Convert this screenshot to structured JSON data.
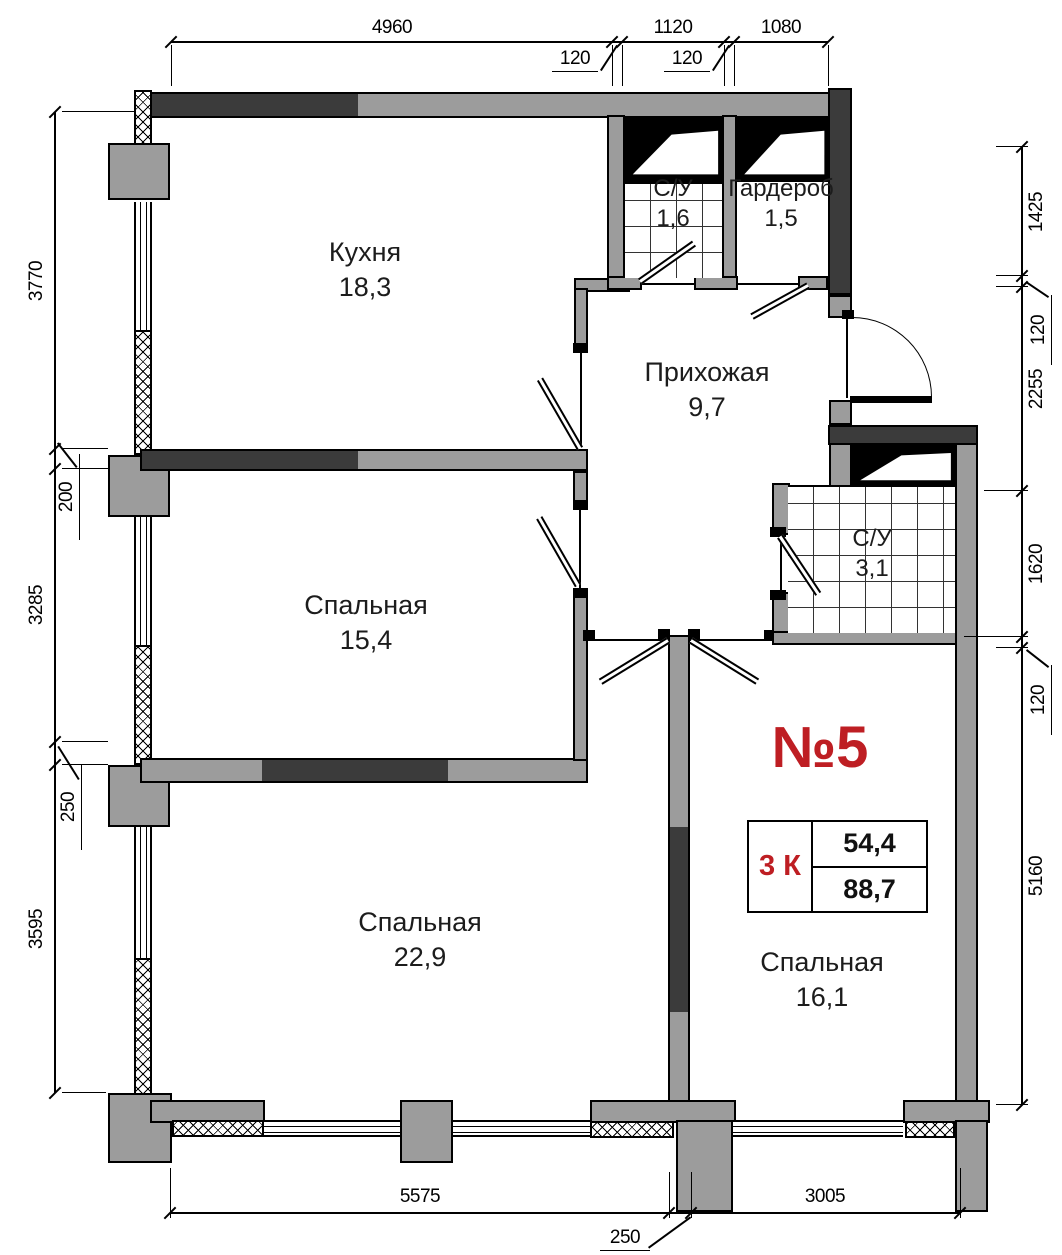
{
  "plan": {
    "apartment_number": "№5",
    "info_table": {
      "rooms_label": "3 К",
      "upper_area": "54,4",
      "lower_area": "88,7"
    },
    "rooms": [
      {
        "name": "Кухня",
        "area": "18,3"
      },
      {
        "name": "С/У",
        "area": "1,6"
      },
      {
        "name": "Гардероб",
        "area": "1,5"
      },
      {
        "name": "Прихожая",
        "area": "9,7"
      },
      {
        "name": "Спальная",
        "area": "15,4"
      },
      {
        "name": "С/У",
        "area": "3,1"
      },
      {
        "name": "Спальная",
        "area": "22,9"
      },
      {
        "name": "Спальная",
        "area": "16,1"
      }
    ],
    "dims": {
      "top": [
        "4960",
        "1120",
        "1080"
      ],
      "top_small": [
        "120",
        "120"
      ],
      "left": [
        "3770",
        "3285",
        "3595"
      ],
      "left_small": [
        "200",
        "250"
      ],
      "right": [
        "1425",
        "2255",
        "1620",
        "5160"
      ],
      "right_small": [
        "120",
        "120"
      ],
      "bottom": [
        "5575",
        "3005"
      ],
      "bottom_small": [
        "250"
      ]
    },
    "colors": {
      "wall_gray": "#9c9c9c",
      "wall_dark": "#3b3b3b",
      "accent_red": "#be1e23"
    }
  }
}
